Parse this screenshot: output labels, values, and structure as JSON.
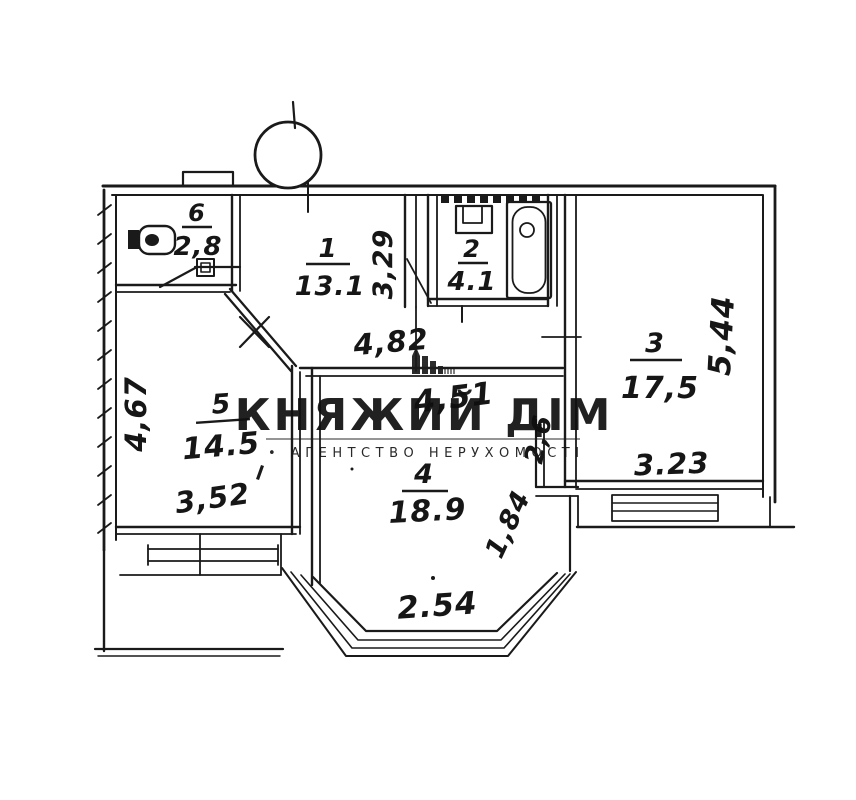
{
  "plan": {
    "rooms": [
      {
        "id": "room-1",
        "number": "1",
        "area": "13.1"
      },
      {
        "id": "room-2",
        "number": "2",
        "area": "4.1"
      },
      {
        "id": "room-3",
        "number": "3",
        "area": "17,5"
      },
      {
        "id": "room-4",
        "number": "4",
        "area": "18.9"
      },
      {
        "id": "room-5",
        "number": "5",
        "area": "14.5"
      },
      {
        "id": "room-6",
        "number": "6",
        "area": "2,8"
      }
    ],
    "dimensions": {
      "d329": "3,29",
      "d482": "4,82",
      "d451": "4,51",
      "d544": "5,44",
      "d467": "4,67",
      "d352": "3,52",
      "d323": "3.23",
      "d254": "2.54",
      "d184": "1,84",
      "d26": "2,6"
    }
  },
  "watermark": {
    "title": "КНЯЖИЙ ДІМ",
    "subtitle": "• АГЕНТСТВО НЕРУХОМОСТІ"
  },
  "colors": {
    "ink": "#1a1a1a",
    "paper": "#ffffff",
    "watermark": "#0f0f0f"
  }
}
